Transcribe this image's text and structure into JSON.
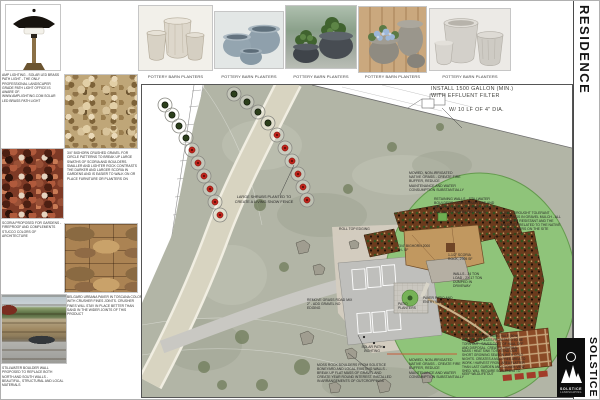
{
  "sheet": {
    "residence_label": "RESIDENCE"
  },
  "top_row": {
    "light_caption": "AMP LIGHTING - SOLAR LED BRASS PATH LIGHT - THE ONLY PROFESSIONAL LANDSCAPER GRADE PATH LIGHT OFFICE IS AWARE OF. www.amplighting.com solar led brass path light",
    "planter_caption": "POTTERY BARN PLANTERS"
  },
  "materials": {
    "gravel_note": "3/4\" BIGHORN CRUSHED GRAVEL FOR CIRCLE PATTERNS TO BREAK UP LARGE SWATHS OF SCORIA AND BOULDERS. SMALLER AND LIGHTER ROCK CONTRASTS THE DARKER AND LARGER SCORIA IN GARDENS AND IS EASIER TO WALK ON OR PLACE FURNITURE OR PLANTERS ON",
    "scoria_note": "SCORIA PROPOSED FOR GARDENS - FIREPROOF AND COMPLEMENTS STUCCO COLORS OF ARCHITECTURE",
    "paver_note": "BELGARD URBANA PAVER IN TOSCANA COLOR WITH CRUSHER FINES JOINTS. CRUSHER FINES WILL STAY IN PLACE BETTER THAN SAND IN THE WIDER JOINTS OF THIS PRODUCT",
    "wall_note": "STILLWATER BOULDER WALL PROPOSED TO REPLACE BOTH NORTH AND SOUTH WALLS - BEAUTIFUL, STRUCTURAL AND LOCAL MATERIALS"
  },
  "plan": {
    "annotations": {
      "septic": "INSTALL 1500 GALLON (MIN.) WITH EFFLUENT FILTER",
      "septic_dia": "W/ 10 LF OF 4\" DIA.",
      "snow_fence": "LARGE SHRUBS PLANTED TO CREATE A LIVING SNOW FENCE",
      "native_grass": "MOWED, NON-IRRIGATED NATIVE GRASS - CREATE FIRE BUFFER, REDUCE MAINTENANCE AND WATER CONSUMPTION SUBSTANTIALLY",
      "retaining_walls": "RETAINING WALLS - STILLWATER BOULDERS - ADD STRUCTURE AND A HIGHER LEVEL OF FINISH THAN CURRENT CRUMBLING WALLS",
      "mixed_plantings": "MIXED, DROUGHT TOLERANT PLANTINGS IN GRAVEL MULCH - ALL ARE DEER RESISTANT AND THE MAJORITY RELATED TO THE NATIVE WILDFLOWERS ON THE SITE",
      "edging": "ROLL TOP EDGING",
      "bighorn_area": "3/4\" BIGHORN 2000 +/- SF",
      "scoria_area": "1-1/2\" SCORIA ROCK, 2905 SF",
      "wall_tons": "WALLS - 34 TON LOAD - 2X 17 TON DUMPED IN DRIVEWAY",
      "paver_patio": "PAVER PATIO AND ENTRY WALK",
      "patio_planters": "PATIO PLANTERS",
      "remove_grass": "REMOVE GRASS ROAD MIX 2\" - ADD GRAVEL NO EDGING",
      "path_lighting": "SOLAR PATH LIGHTING",
      "moss_rock": "MOSS ROCK BOULDERS FROM SOLSTICE BONEYARD AND LOCAL EXISTING WALLS - BREAK UP FLAT MASS OF GRAVEL AND CREATE YEAR ROUND INTEREST. INSTALLED IN ARRANGEMENTS OF OUTCROPPINGS",
      "native_grass_2": "MOWED, NON-IRRIGATED NATIVE GRASS - CREATE FIRE BUFFER, REDUCE MAINTENANCE AND WATER CONSUMPTION SUBSTANTIALLY",
      "veggie_garden": "VEGGIE GARDEN USING HALF (50%) CONCRETE PIECES FROM PATIO TO BE TORN OUT - SAVES COST OF HAUL OFF AND DISPOSAL. CREATES THERMAL MASS / HEAT SINK TO EXTEND OUR SHORT GROWING SEASON WITH COLD NIGHTS. CREATES A MUD-FREE AREA TO WORK / HARVEST FROM. AREA FLATTER THAN LAST GARDEN AND CLOSER VIEW SHED. WILL REQUIRE SCREENING TO KEEP WILDLIFE OUT"
    }
  },
  "title_block": {
    "logo_name": "SOLSTICE",
    "logo_sub": "LANDSCAPING",
    "logo_vertical": "SOLSTICE"
  },
  "colors": {
    "plan_green": "#8fc47a",
    "bed_brown": "#6b3b1d",
    "aerial": "#b2b5a6",
    "accent_red": "#bf241b"
  }
}
